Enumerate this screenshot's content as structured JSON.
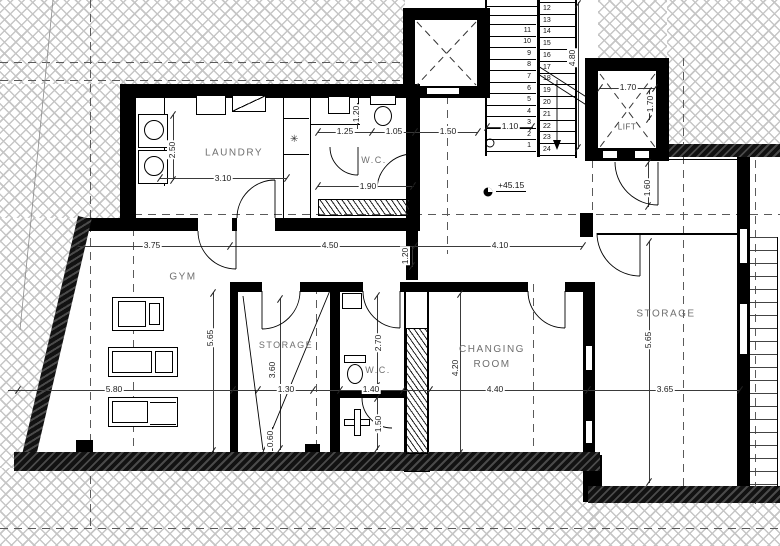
{
  "rooms": {
    "laundry": "LAUNDRY",
    "wc_upper": "W.C.",
    "gym": "GYM",
    "storage_middle": "STORAGE",
    "wc_lower": "W.C.",
    "changing_line1": "CHANGING",
    "changing_line2": "ROOM",
    "storage_right": "STORAGE",
    "lift": "LIFT"
  },
  "level_marker": "+45.15",
  "dims": {
    "laundry_h": "2.50",
    "laundry_w": "3.10",
    "wc_upper_a": "1.25",
    "wc_upper_b": "1.20",
    "wc_upper_c": "1.05",
    "wc_upper_d": "1.50",
    "wc_upper_e": "1.90",
    "stairs_w": "1.10",
    "stairs_h": "4.80",
    "lift_w": "1.70",
    "lift_d": "1.70",
    "lift_door": "1.60",
    "row_a": "3.75",
    "row_b": "4.50",
    "row_c": "1.20",
    "row_d": "4.10",
    "gym_w": "5.80",
    "gym_h": "5.65",
    "storage_mid_h": "3.60",
    "storage_mid_w": "1.30",
    "storage_mid_b": "0.60",
    "wc_lower_h": "2.70",
    "wc_lower_w": "1.40",
    "wc_lower_b": "1.50",
    "changing_w": "4.40",
    "changing_h": "4.20",
    "storage_right_h": "5.65",
    "storage_right_w": "3.65"
  },
  "stairs": {
    "left_flight": [
      "11",
      "10",
      "9",
      "8",
      "7",
      "6",
      "5",
      "4",
      "3",
      "2",
      "1"
    ],
    "right_flight": [
      "12",
      "13",
      "14",
      "15",
      "16",
      "17",
      "18",
      "19",
      "20",
      "21",
      "22",
      "23",
      "24"
    ]
  },
  "symbols": {
    "fixture_star": "✳"
  }
}
